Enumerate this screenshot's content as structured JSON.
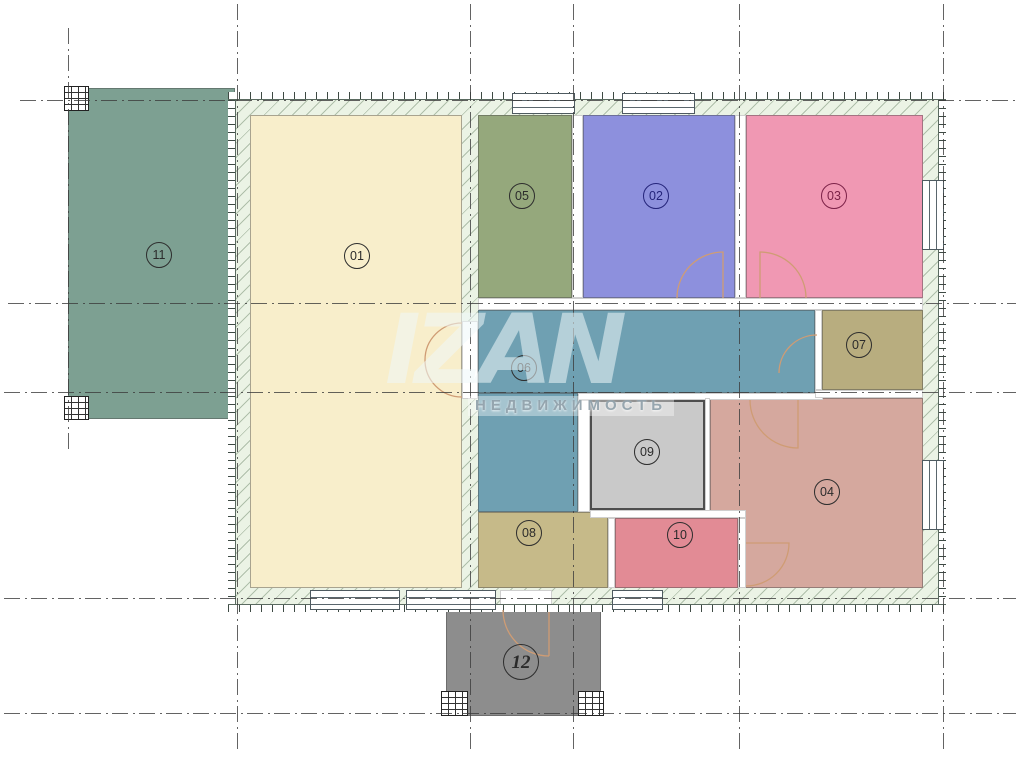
{
  "canvas": {
    "width": 1023,
    "height": 758,
    "background": "#ffffff"
  },
  "watermark": {
    "logo": "IZAN",
    "subtitle": "НЕДВИЖИМОСТЬ"
  },
  "palette": {
    "wall_hatch_bg": "#ebf3e5",
    "building_outline": "#3a5a46",
    "grid_line": "#3c3c3c",
    "door_swing": "#cf9c74"
  },
  "building": {
    "rect": [
      228,
      92,
      718,
      520
    ]
  },
  "rooms": [
    {
      "id": "11",
      "label": "11",
      "color": "#7da092",
      "rects": [
        [
          68,
          88,
          167,
          331
        ]
      ],
      "label_pos": [
        159,
        255
      ],
      "outside": true
    },
    {
      "id": "12",
      "label": "12",
      "color": "#8d8d8d",
      "rects": [
        [
          446,
          610,
          155,
          106
        ]
      ],
      "label_pos": [
        521,
        662
      ],
      "label_size": 36,
      "italic": true,
      "outside": true
    },
    {
      "id": "01",
      "label": "01",
      "color": "#f8eecb",
      "rects": [
        [
          250,
          115,
          212,
          473
        ]
      ],
      "label_pos": [
        357,
        256
      ]
    },
    {
      "id": "05",
      "label": "05",
      "color": "#95a87c",
      "rects": [
        [
          478,
          115,
          94,
          183
        ]
      ],
      "label_pos": [
        522,
        196
      ]
    },
    {
      "id": "02",
      "label": "02",
      "color": "#8d90dd",
      "rects": [
        [
          583,
          115,
          152,
          183
        ]
      ],
      "label_pos": [
        656,
        196
      ],
      "label_color": "#24247a"
    },
    {
      "id": "03",
      "label": "03",
      "color": "#f098b3",
      "rects": [
        [
          746,
          115,
          177,
          183
        ]
      ],
      "label_pos": [
        834,
        196
      ],
      "label_color": "#7c2248"
    },
    {
      "id": "06",
      "label": "06",
      "color": "#6fa0b2",
      "rects": [
        [
          478,
          310,
          337,
          83
        ],
        [
          478,
          393,
          100,
          119
        ]
      ],
      "label_pos": [
        524,
        368
      ]
    },
    {
      "id": "07",
      "label": "07",
      "color": "#b8ad7f",
      "rects": [
        [
          822,
          310,
          101,
          80
        ]
      ],
      "label_pos": [
        859,
        345
      ]
    },
    {
      "id": "04",
      "label": "04",
      "color": "#d5a89e",
      "rects": [
        [
          710,
          398,
          213,
          190
        ]
      ],
      "label_pos": [
        827,
        492
      ]
    },
    {
      "id": "09",
      "label": "09",
      "color": "#c9c9c9",
      "rects": [
        [
          590,
          400,
          115,
          110
        ]
      ],
      "label_pos": [
        647,
        452
      ],
      "border": "2px solid #4e4e4e"
    },
    {
      "id": "10",
      "label": "10",
      "color": "#e28b95",
      "rects": [
        [
          615,
          518,
          123,
          70
        ]
      ],
      "label_pos": [
        680,
        535
      ]
    },
    {
      "id": "08",
      "label": "08",
      "color": "#c6ba89",
      "rects": [
        [
          478,
          512,
          130,
          76
        ]
      ],
      "label_pos": [
        529,
        533
      ]
    }
  ],
  "wall_bands": [
    {
      "type": "top",
      "rect": [
        228,
        92,
        718,
        8
      ]
    },
    {
      "type": "bottom",
      "rect": [
        228,
        604,
        718,
        8
      ]
    },
    {
      "type": "left",
      "rect": [
        228,
        100,
        8,
        504
      ]
    },
    {
      "type": "right",
      "rect": [
        938,
        100,
        8,
        504
      ]
    }
  ],
  "wall_segments": [
    [
      572,
      115,
      11,
      183
    ],
    [
      735,
      115,
      11,
      183
    ],
    [
      478,
      298,
      445,
      12
    ],
    [
      578,
      393,
      245,
      7
    ],
    [
      815,
      390,
      108,
      8
    ],
    [
      815,
      310,
      7,
      80
    ],
    [
      578,
      400,
      12,
      112
    ],
    [
      705,
      398,
      5,
      114
    ],
    [
      590,
      510,
      156,
      8
    ],
    [
      608,
      518,
      7,
      70
    ],
    [
      738,
      518,
      8,
      70
    ],
    [
      462,
      321,
      16,
      78
    ],
    [
      500,
      590,
      52,
      22
    ]
  ],
  "windows": [
    {
      "orient": "h",
      "rect": [
        512,
        93,
        63,
        21
      ]
    },
    {
      "orient": "h",
      "rect": [
        622,
        93,
        73,
        21
      ]
    },
    {
      "orient": "v",
      "rect": [
        922,
        180,
        22,
        70
      ]
    },
    {
      "orient": "v",
      "rect": [
        922,
        460,
        22,
        70
      ]
    },
    {
      "orient": "h",
      "rect": [
        310,
        590,
        90,
        20
      ]
    },
    {
      "orient": "h",
      "rect": [
        406,
        590,
        90,
        20
      ]
    },
    {
      "orient": "h",
      "rect": [
        612,
        590,
        51,
        20
      ]
    }
  ],
  "piers": [
    [
      64,
      86,
      25,
      25
    ],
    [
      64,
      396,
      25,
      24
    ],
    [
      441,
      691,
      27,
      25
    ],
    [
      578,
      691,
      26,
      25
    ]
  ],
  "doors": [
    {
      "name": "double-door-01",
      "d": "M 462 323 A 37 37 0 0 0 425 360 M 462 397 A 37 37 0 0 1 425 360"
    },
    {
      "name": "door-02",
      "d": "M 723 298 L 723 252 A 46 46 0 0 0 677 298"
    },
    {
      "name": "door-03",
      "d": "M 760 298 L 760 252 A 46 46 0 0 1 806 298"
    },
    {
      "name": "door-06-07",
      "d": "M 817 335 A 38 38 0 0 0 779 373"
    },
    {
      "name": "door-06-04",
      "d": "M 750 400 A 48 48 0 0 0 798 448 L 798 400"
    },
    {
      "name": "door-04-10",
      "d": "M 746 543 L 789 543 A 43 43 0 0 1 746 586"
    },
    {
      "name": "entrance-door",
      "d": "M 549 612 L 549 656 M 503 610 A 46 46 0 0 0 549 656"
    }
  ],
  "gridlines": {
    "vertical": [
      {
        "x": 68,
        "y1": 28,
        "y2": 452
      },
      {
        "x": 237,
        "y1": 4,
        "y2": 754
      },
      {
        "x": 470,
        "y1": 4,
        "y2": 754
      },
      {
        "x": 573,
        "y1": 4,
        "y2": 754
      },
      {
        "x": 739,
        "y1": 4,
        "y2": 754
      },
      {
        "x": 943,
        "y1": 4,
        "y2": 754
      }
    ],
    "horizontal": [
      {
        "y": 100,
        "x1": 20,
        "x2": 1016
      },
      {
        "y": 303,
        "x1": 8,
        "x2": 1016
      },
      {
        "y": 392,
        "x1": 4,
        "x2": 1016
      },
      {
        "y": 598,
        "x1": 4,
        "x2": 1016
      },
      {
        "y": 713,
        "x1": 4,
        "x2": 1016
      }
    ]
  }
}
